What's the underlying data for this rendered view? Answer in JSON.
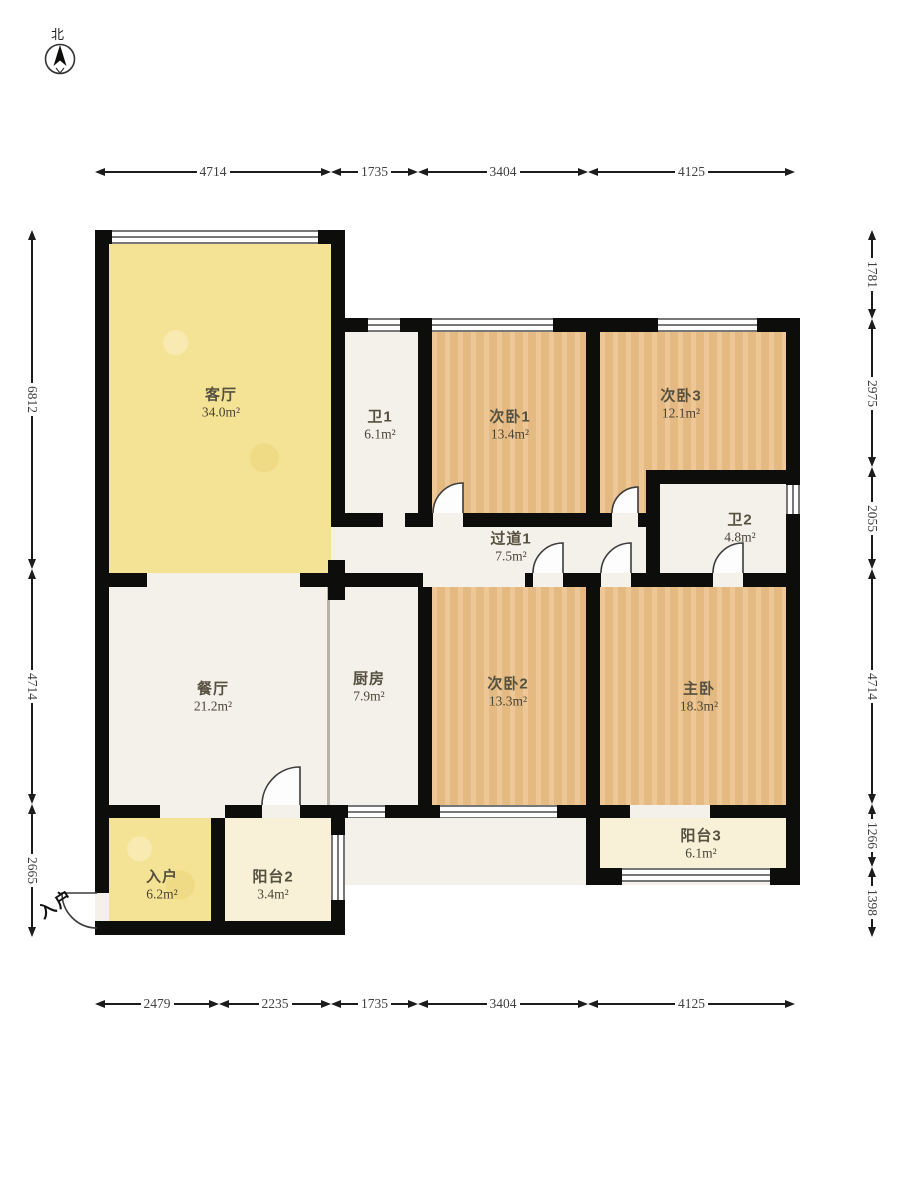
{
  "plan": {
    "north_label": "北",
    "entry_door_label": "入户",
    "rooms": [
      {
        "name": "客厅",
        "area": "34.0m²"
      },
      {
        "name": "卫1",
        "area": "6.1m²"
      },
      {
        "name": "次卧1",
        "area": "13.4m²"
      },
      {
        "name": "次卧3",
        "area": "12.1m²"
      },
      {
        "name": "卫2",
        "area": "4.8m²"
      },
      {
        "name": "过道1",
        "area": "7.5m²"
      },
      {
        "name": "餐厅",
        "area": "21.2m²"
      },
      {
        "name": "厨房",
        "area": "7.9m²"
      },
      {
        "name": "次卧2",
        "area": "13.3m²"
      },
      {
        "name": "主卧",
        "area": "18.3m²"
      },
      {
        "name": "入户",
        "area": "6.2m²"
      },
      {
        "name": "阳台2",
        "area": "3.4m²"
      },
      {
        "name": "阳台3",
        "area": "6.1m²"
      }
    ],
    "dimensions": {
      "top": [
        "4714",
        "1735",
        "3404",
        "4125"
      ],
      "bottom": [
        "2479",
        "2235",
        "1735",
        "3404",
        "4125"
      ],
      "left": [
        "6812",
        "4714",
        "2665"
      ],
      "right": [
        "1781",
        "2975",
        "2055",
        "4714",
        "1266",
        "1398"
      ]
    },
    "colors": {
      "wall": "#0d0d0c",
      "living_yellow": "#f5e395",
      "bedroom_wood": "#ebc189",
      "marble_white": "#f4f1ea",
      "balcony_cream": "#f8f1d7"
    }
  }
}
